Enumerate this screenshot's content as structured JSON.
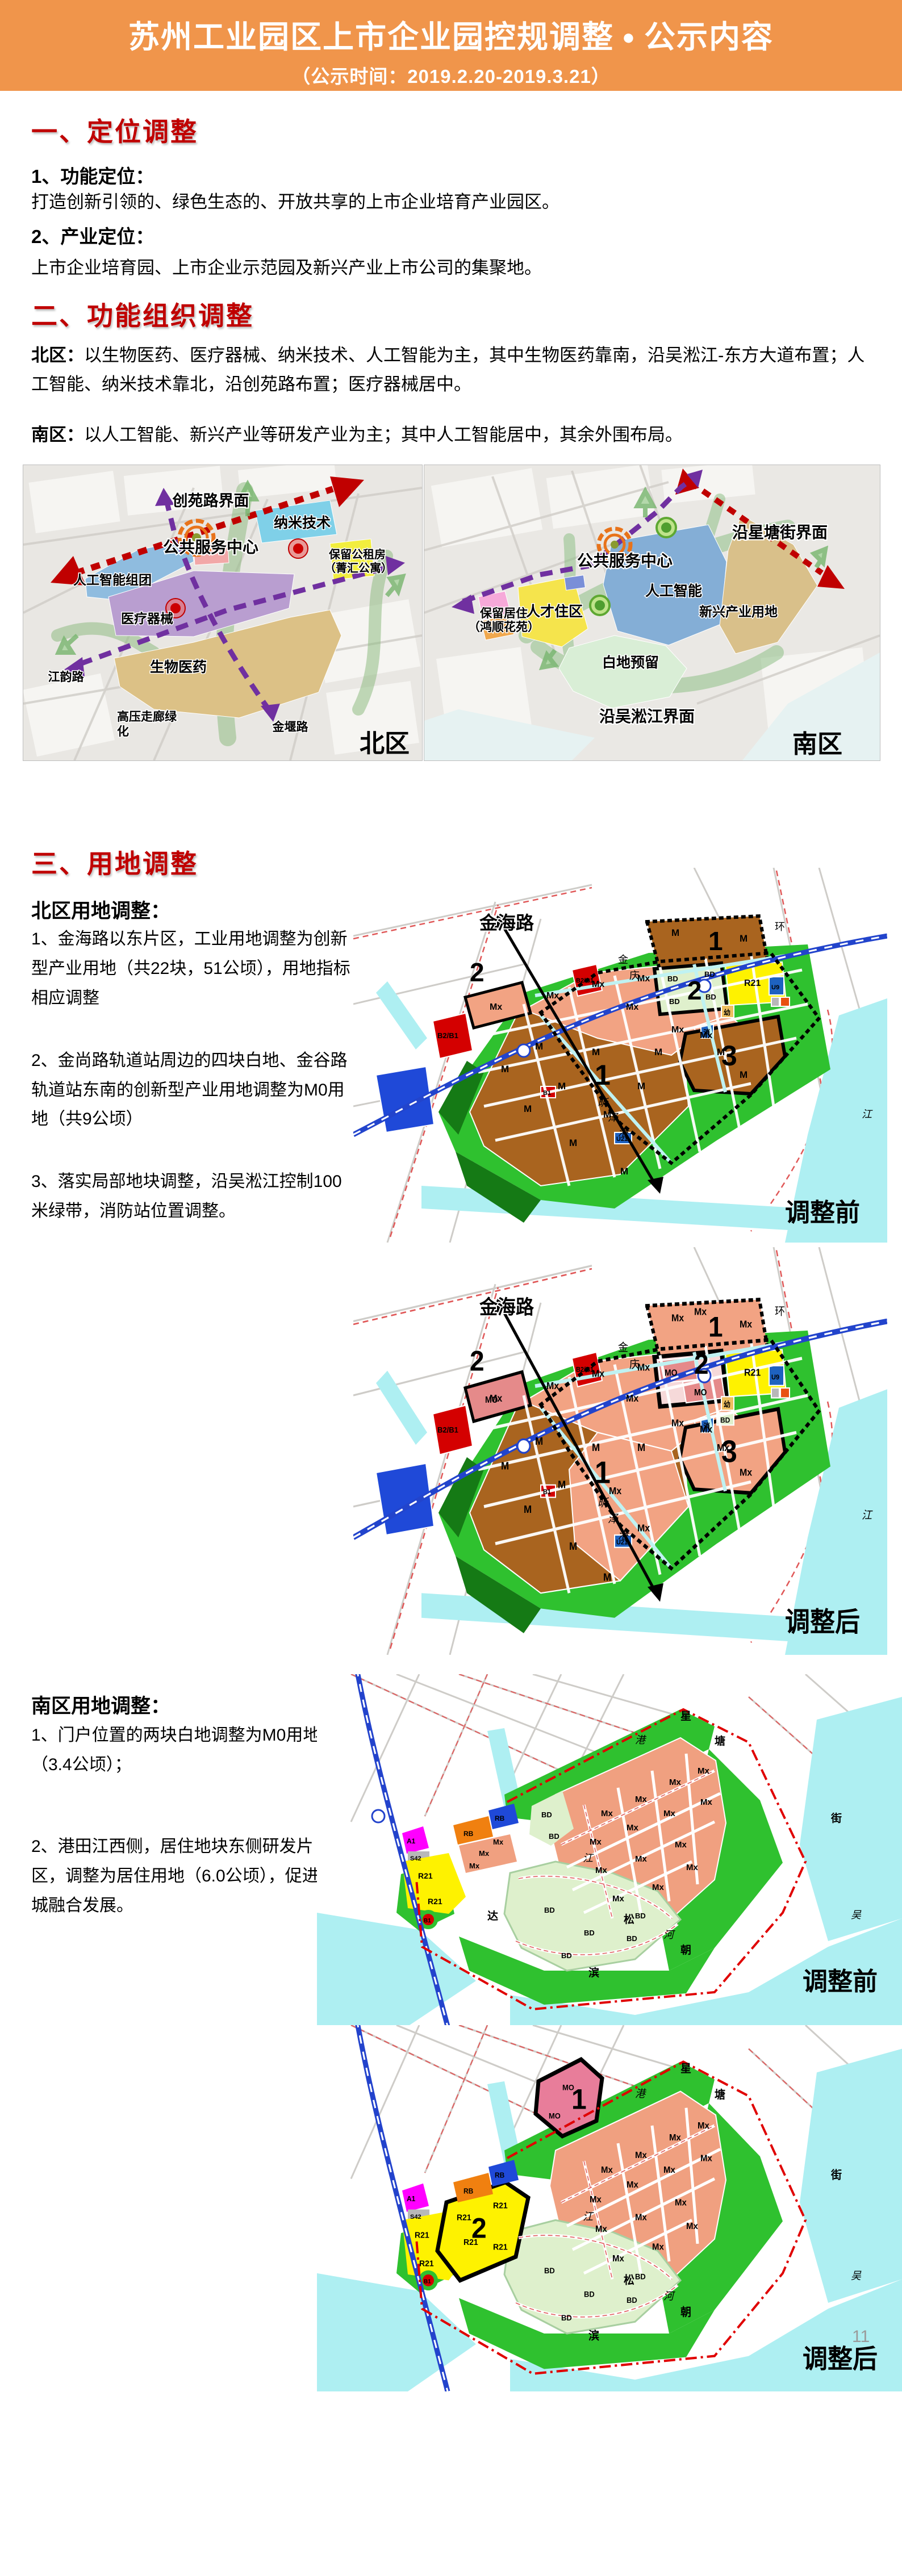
{
  "page": {
    "number": "11"
  },
  "header": {
    "title": "苏州工业园区上市企业园控规调整",
    "bullet": "●",
    "suffix": "公示内容",
    "subtitle": "（公示时间：2019.2.20-2019.3.21）",
    "bg_color": "#F0954B"
  },
  "sections": {
    "s1": {
      "title": "一、定位调整",
      "item1_head": "1、功能定位：",
      "item1_text": "打造创新引领的、绿色生态的、开放共享的上市企业培育产业园区。",
      "item2_head": "2、产业定位：",
      "item2_text": "上市企业培育园、上市企业示范园及新兴产业上市公司的集聚地。"
    },
    "s2": {
      "title": "二、功能组织调整",
      "north_label": "北区：",
      "north_text": "以生物医药、医疗器械、纳米技术、人工智能为主，其中生物医药靠南，沿吴淞江-东方大道布置；人工智能、纳米技术靠北，沿创苑路布置；医疗器械居中。",
      "south_label": "南区：",
      "south_text": "以人工智能、新兴产业等研发产业为主；其中人工智能居中，其余外围布局。"
    },
    "s3": {
      "title": "三、用地调整",
      "north_head": "北区用地调整：",
      "north_items": [
        "1、金海路以东片区，工业用地调整为创新型产业用地（共22块，51公顷），用地指标相应调整",
        "2、金尚路轨道站周边的四块白地、金谷路轨道站东南的创新型产业用地调整为M0用地（共9公顷）",
        "3、落实局部地块调整，沿吴淞江控制100米绿带，消防站位置调整。"
      ],
      "south_head": "南区用地调整：",
      "south_items": [
        "1、门户位置的两块白地调整为M0用地（3.4公顷）；",
        "2、港田江西侧，居住地块东侧研发片区，调整为居住用地（6.0公顷），促进产城融合发展。"
      ]
    }
  },
  "maps": {
    "tag_before": "调整前",
    "tag_after": "调整后",
    "jinhai_road": "金海路",
    "codes": {
      "m": "M",
      "mx": "Mx",
      "m0": "MO",
      "bd": "BD",
      "r21": "R21",
      "b2b1": "B2/B1",
      "b1": "B1",
      "u9": "U9",
      "u21": "U21",
      "a1": "A1",
      "rb": "RB",
      "s42": "S42"
    },
    "markers": {
      "one": "1",
      "two": "2",
      "three": "3"
    },
    "chars": {
      "jin": "金",
      "qing": "庆",
      "xin": "昕",
      "ze": "泽",
      "gang": "港",
      "jiang": "江",
      "he": "河",
      "wu": "吴",
      "xing": "星",
      "tang": "塘",
      "jie": "街",
      "song": "松",
      "bin": "滨",
      "da": "达",
      "chao": "朝",
      "xiao": "消",
      "you": "幼",
      "huan": "环"
    },
    "north_schematic": {
      "labels": {
        "interface": "创苑路界面",
        "nano": "纳米技术",
        "center": "公共服务中心",
        "rental1": "保留公租房",
        "rental2": "（菁汇公寓）",
        "ai": "人工智能组团",
        "medical": "医疗器械",
        "bio": "生物医药",
        "jiangyun": "江韵路",
        "hv1": "高压走廊绿",
        "hv2": "化",
        "jinyan": "金堰路",
        "tag": "北区"
      }
    },
    "south_schematic": {
      "labels": {
        "interface": "沿星塘街界面",
        "center": "公共服务中心",
        "ai": "人工智能",
        "emerging": "新兴产业用地",
        "reside1": "保留居住",
        "reside2": "（鸿顺花苑）",
        "talent": "人才住区",
        "white": "白地预留",
        "wusong": "沿吴淞江界面",
        "tag": "南区"
      }
    }
  },
  "colors": {
    "header_bg": "#F0954B",
    "heading_red": "#C00000",
    "m_brown": "#A9641F",
    "mx_salmon": "#F2A383",
    "m0_pink": "#E58A8A",
    "bd_pale_green": "#DDF0CA",
    "r21_yellow": "#FEF200",
    "b_red": "#D40000",
    "u_blue": "#1E62C0",
    "water_cyan": "#AEEFF2",
    "green_open": "#2FC12F",
    "purple_route": "#7030A0",
    "interface_red": "#C00000"
  }
}
